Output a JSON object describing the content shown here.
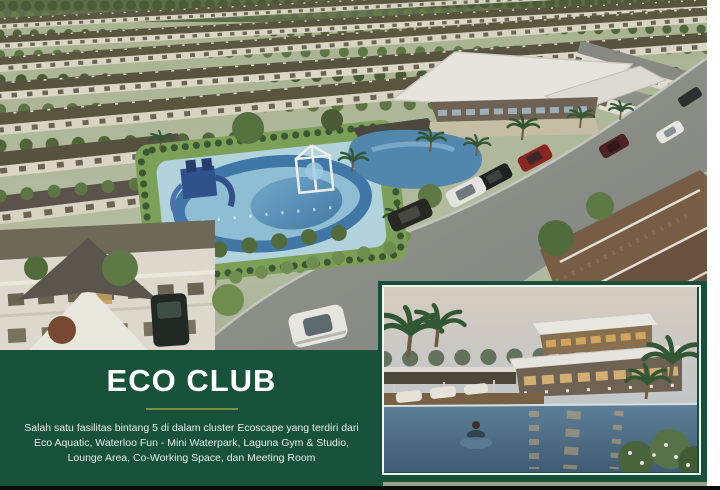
{
  "page": {
    "width": 720,
    "height": 490,
    "background_color": "#ffffff",
    "bottom_bar_color": "#0a0a0a",
    "right_margin_color": "#ffffff"
  },
  "banner": {
    "title": "ECO CLUB",
    "background_color": "#18523a",
    "title_color": "#ffffff",
    "divider_color": "#7c8f43",
    "description_lines": [
      "Salah satu fasilitas bintang 5  di dalam cluster Ecoscape yang terdiri dari",
      "Eco Aquatic, Waterloo Fun - Mini Waterpark, Laguna Gym & Studio,",
      "Lounge Area, Co-Working Space, dan Meeting Room"
    ]
  },
  "main_photo": {
    "description": "Aerial render of Ecoscape residential cluster: rows of two-storey houses, Eco Club mini waterpark with blue slides, modern white-roof clubhouse, lagoon pool, tree-lined street with parked cars"
  },
  "inset_photo": {
    "description": "Dusk render of Eco Club clubhouse with cantilevered white roofs, infinity pool, palm trees, lounge daybeds and a swimmer",
    "frame_color": "#14503a",
    "inner_border_color": "#f2f4ef"
  }
}
